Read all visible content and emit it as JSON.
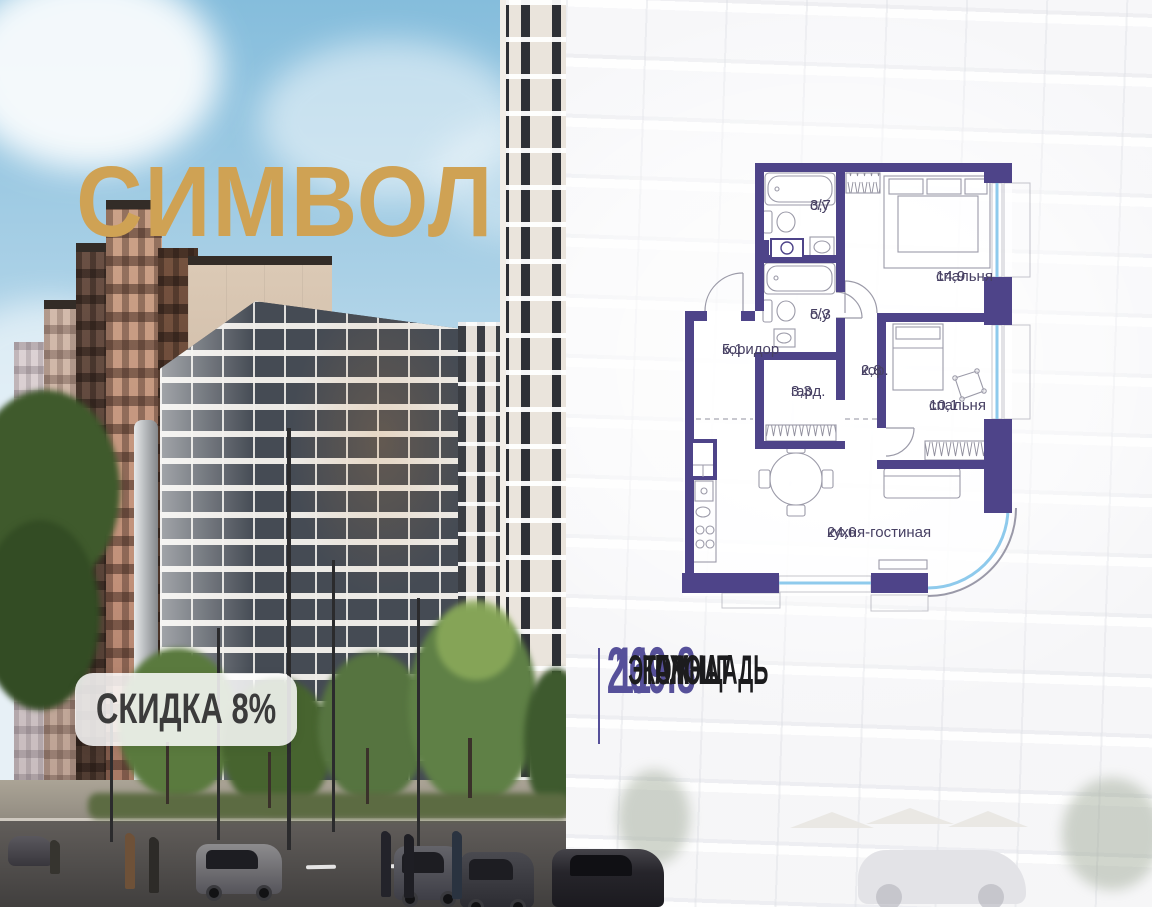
{
  "brand": {
    "logo_text": "СИМВОЛ"
  },
  "badge": {
    "label": "СКИДКА 8%"
  },
  "floorplan": {
    "rooms": [
      {
        "name": "с/у",
        "area": "3,7"
      },
      {
        "name": "спальня",
        "area": "14,9"
      },
      {
        "name": "с/у",
        "area": "5,3"
      },
      {
        "name": "коридор",
        "area": "5,1"
      },
      {
        "name": "гард.",
        "area": "3,3"
      },
      {
        "name": "кор.",
        "area": "2,8"
      },
      {
        "name": "спальня",
        "area": "10,1"
      },
      {
        "name": "кухня-гостиная",
        "area": "24,6"
      }
    ]
  },
  "stats": {
    "items": [
      {
        "value": "69.8",
        "label": "ПЛОЩАДЬ"
      },
      {
        "value": "11",
        "label": "ЭТАЖ"
      },
      {
        "value": "2",
        "label": "КОМНАТ"
      }
    ]
  },
  "colors": {
    "accent": "#56509a",
    "wall": "#4e4489",
    "gold": "#cfa254",
    "window_blue": "#8ecaec"
  }
}
